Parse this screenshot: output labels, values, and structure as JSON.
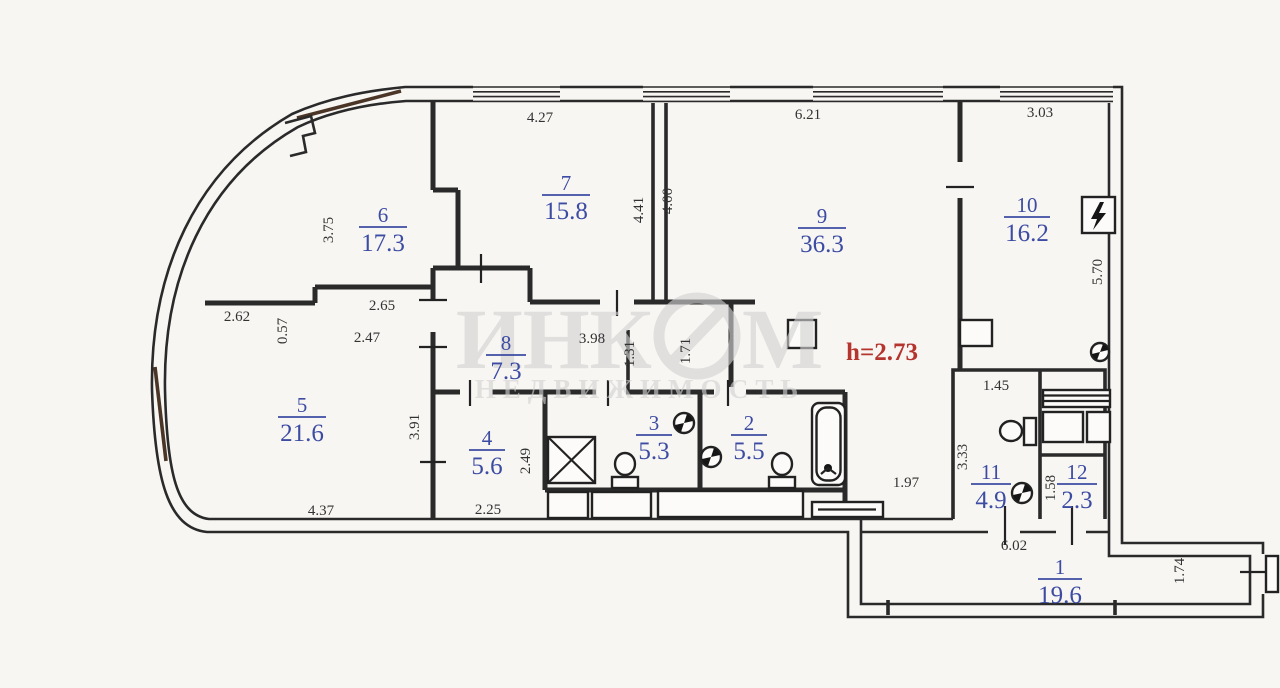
{
  "plan": {
    "watermark": {
      "brand_part1": "ИНК",
      "brand_part2": "М",
      "subtitle": "НЕДВИЖИМОСТЬ"
    },
    "ceiling_height_label": "h=2.73",
    "colors": {
      "room_label": "#3d4ca3",
      "dimension_text": "#323232",
      "height_label": "#b5342e",
      "wall": "#2a2a2a",
      "watermark": "#d2d2d2"
    },
    "rooms": [
      {
        "number": "1",
        "area": "19.6"
      },
      {
        "number": "2",
        "area": "5.5"
      },
      {
        "number": "3",
        "area": "5.3"
      },
      {
        "number": "4",
        "area": "5.6"
      },
      {
        "number": "5",
        "area": "21.6"
      },
      {
        "number": "6",
        "area": "17.3"
      },
      {
        "number": "7",
        "area": "15.8"
      },
      {
        "number": "8",
        "area": "7.3"
      },
      {
        "number": "9",
        "area": "36.3"
      },
      {
        "number": "10",
        "area": "16.2"
      },
      {
        "number": "11",
        "area": "4.9"
      },
      {
        "number": "12",
        "area": "2.3"
      }
    ],
    "dims": [
      "4.27",
      "6.21",
      "3.03",
      "3.75",
      "4.41",
      "4.00",
      "5.70",
      "2.62",
      "0.57",
      "2.65",
      "2.47",
      "3.98",
      "1.31",
      "1.71",
      "3.91",
      "2.49",
      "2.25",
      "4.37",
      "1.97",
      "1.45",
      "3.33",
      "1.58",
      "6.02",
      "1.74"
    ]
  }
}
